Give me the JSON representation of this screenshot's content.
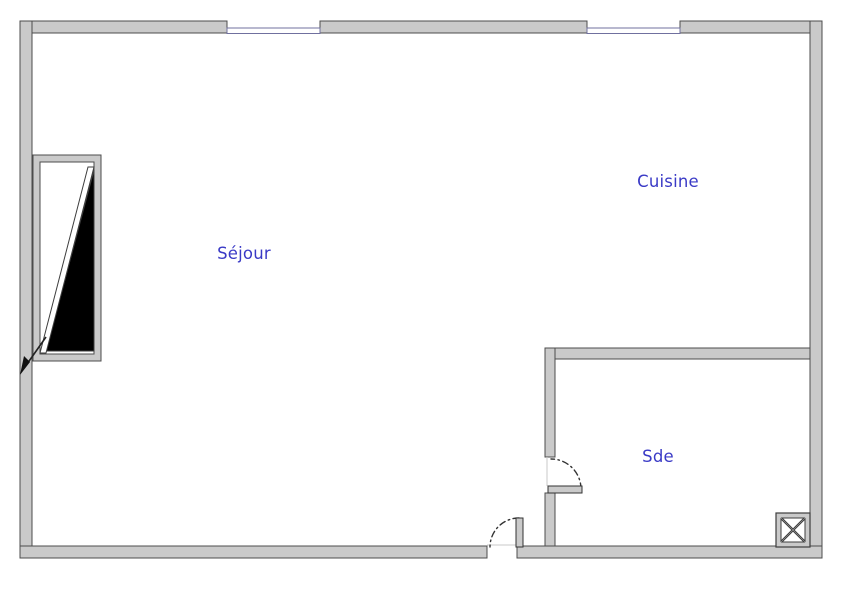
{
  "plan": {
    "title": "apartment-floor-plan",
    "rooms": [
      {
        "id": "sejour",
        "label": "Séjour"
      },
      {
        "id": "cuisine",
        "label": "Cuisine"
      },
      {
        "id": "sde",
        "label": "Sde"
      }
    ],
    "symbols": {
      "windows": [
        "window-symbol-top-left",
        "window-symbol-top-right"
      ],
      "doors": [
        "entrance-door-swing",
        "sde-door-swing"
      ],
      "other": [
        "stair-triangle-symbol",
        "duct-shaft-symbol",
        "direction-arrow"
      ]
    },
    "colors": {
      "wall_fill": "#cacaca",
      "wall_outline": "#4c4c4c",
      "window_line": "#70709f",
      "room_label": "#3a3ac6",
      "stair_fill": "#000000",
      "background": "#ffffff"
    }
  }
}
